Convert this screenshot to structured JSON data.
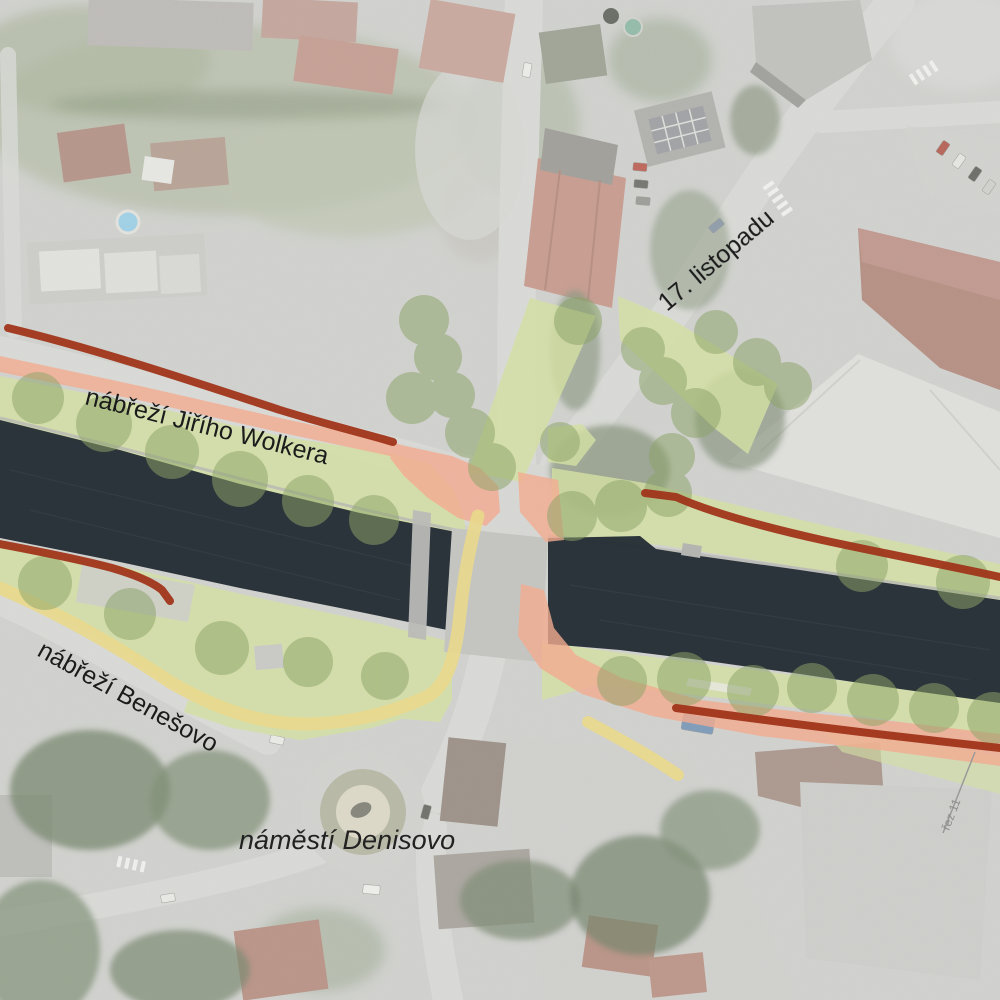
{
  "map": {
    "description": "Aerial orthophoto of a riverfront bridge intersection with a landscape/mobility plan overlay (greenways, tree canopies, new paved promenades, footpaths and route lines)",
    "labels": {
      "street_nw": "nábřeží Jiřího Wolkera",
      "street_ne": "17. listopadu",
      "street_sw": "nábřeží Benešovo",
      "square": "náměstí Denisovo",
      "section_marker": "řez 11"
    },
    "overlay": {
      "river": "#232b33",
      "greenway": "#d3e0a4",
      "tree_canopy": "#8da369",
      "paved_surface": "#f3ab90",
      "footpath": "#e9d88c",
      "route_line": "#a0351a"
    }
  }
}
